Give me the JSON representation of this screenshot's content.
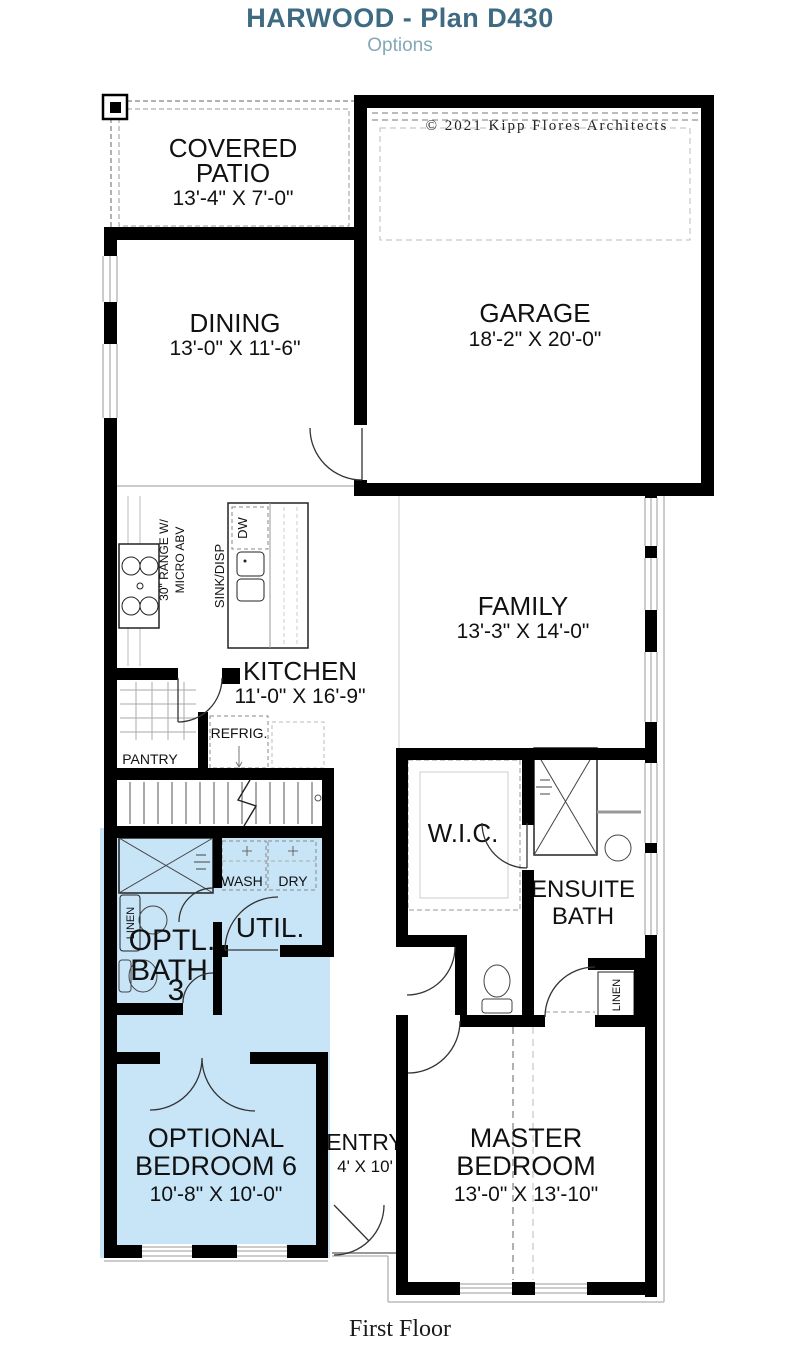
{
  "header": {
    "title": "HARWOOD - Plan D430",
    "subtitle": "Options"
  },
  "plan": {
    "copyright": "© 2021  Kipp Flores Architects",
    "rooms": {
      "covered_patio": {
        "name1": "COVERED",
        "name2": "PATIO",
        "dims": "13'-4\" X 7'-0\""
      },
      "garage": {
        "name": "GARAGE",
        "dims": "18'-2\" X 20'-0\""
      },
      "dining": {
        "name": "DINING",
        "dims": "13'-0\" X 11'-6\""
      },
      "family": {
        "name": "FAMILY",
        "dims": "13'-3\" X 14'-0\""
      },
      "kitchen": {
        "name": "KITCHEN",
        "dims": "11'-0\" X 16'-9\""
      },
      "wic": {
        "name": "W.I.C."
      },
      "ensuite_bath": {
        "name1": "ENSUITE",
        "name2": "BATH"
      },
      "optional_bath": {
        "name1": "OPTL.",
        "name2": "BATH",
        "name3": "3"
      },
      "utility": {
        "name": "UTIL."
      },
      "optional_bedroom": {
        "name1": "OPTIONAL",
        "name2": "BEDROOM 6",
        "dims": "10'-8\" X 10'-0\""
      },
      "entry": {
        "name": "ENTRY",
        "dims": "4' X 10'"
      },
      "master_bedroom": {
        "name1": "MASTER",
        "name2": "BEDROOM",
        "dims": "13'-0\" X 13'-10\""
      }
    },
    "fixtures": {
      "range1": "30\" RANGE W/",
      "range2": "MICRO ABV",
      "dishwasher": "DW",
      "sink": "SINK/DISP",
      "refrigerator": "REFRIG.",
      "pantry": "PANTRY",
      "washer": "WASH",
      "dryer": "DRY",
      "linen_bath": "LINEN",
      "linen_hall": "LINEN"
    }
  },
  "footer": {
    "label": "First Floor"
  },
  "colors": {
    "title": "#3e6a82",
    "subtitle": "#84a8b7",
    "highlight": "#c8e5f8",
    "wall": "#000000"
  }
}
